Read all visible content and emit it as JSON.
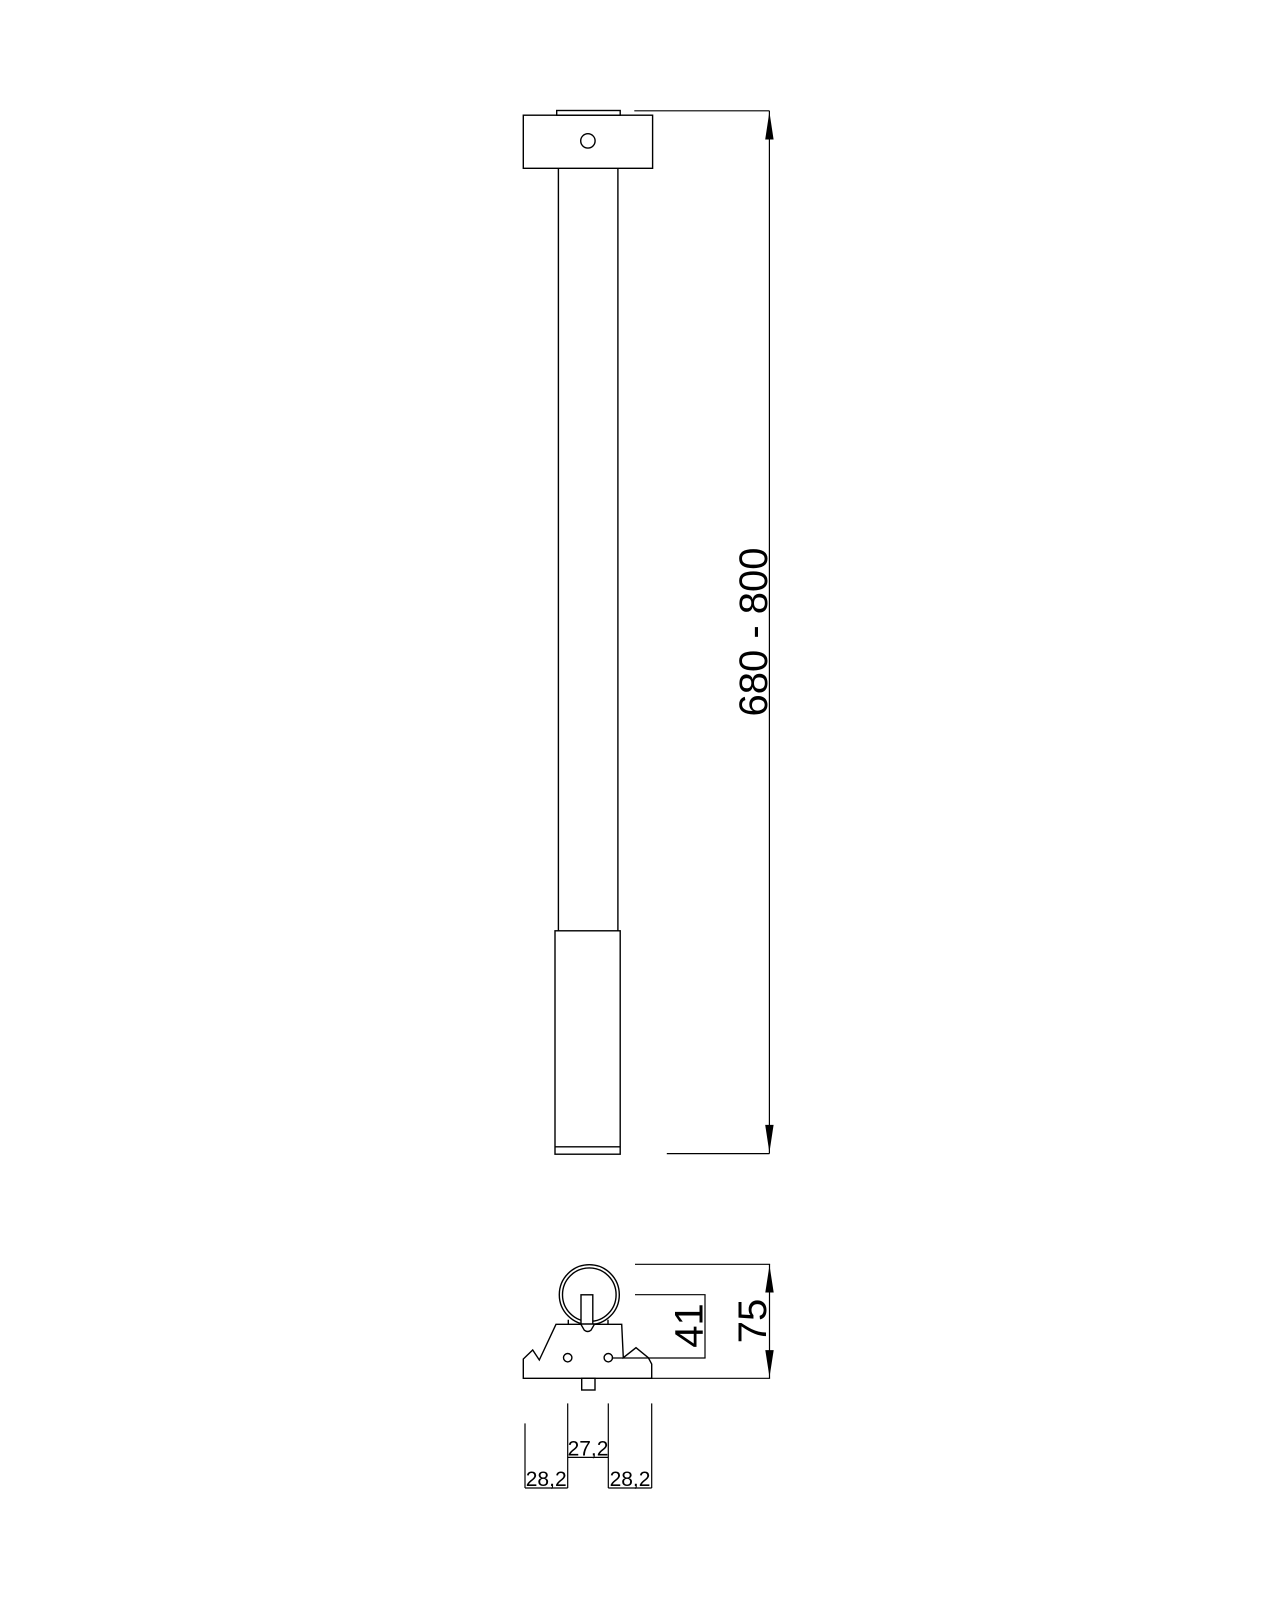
{
  "colors": {
    "line": "#000000",
    "background": "#ffffff"
  },
  "front_view": {
    "height_range_label": "680 - 800"
  },
  "bottom_view": {
    "center_to_holes_label": "41",
    "overall_size_label": "75",
    "hole_spacing_label": "27,2",
    "left_offset_label": "28,2",
    "right_offset_label": "28,2"
  }
}
